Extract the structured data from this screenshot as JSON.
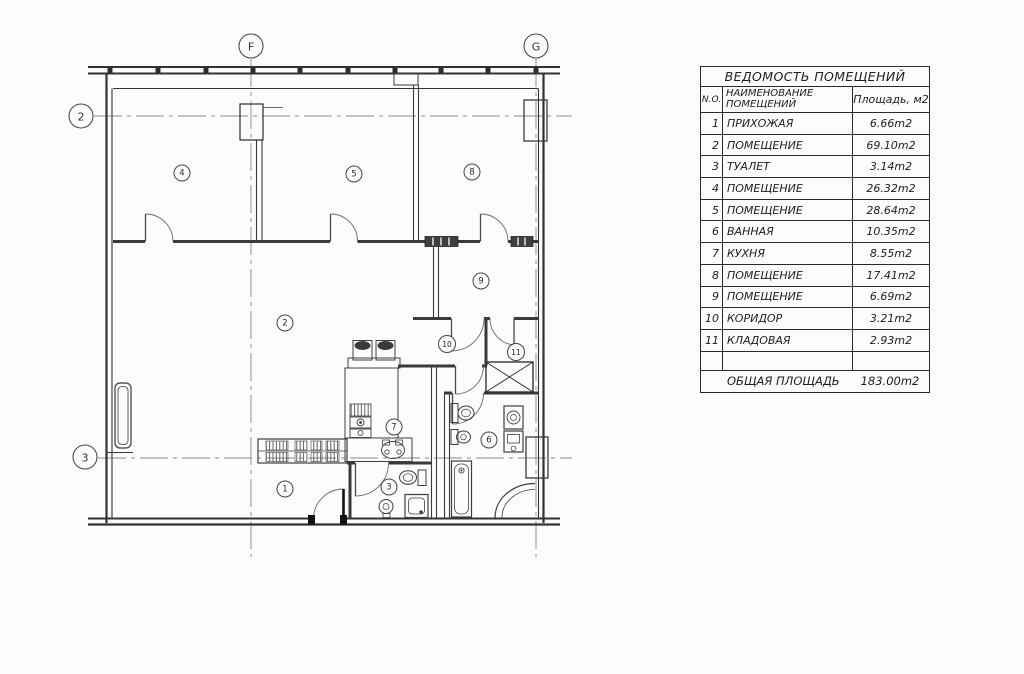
{
  "plan": {
    "grid_markers": [
      {
        "label": "F"
      },
      {
        "label": "G"
      },
      {
        "label": "2"
      },
      {
        "label": "3"
      }
    ],
    "rooms": [
      {
        "label": "1"
      },
      {
        "label": "2"
      },
      {
        "label": "3"
      },
      {
        "label": "4"
      },
      {
        "label": "5"
      },
      {
        "label": "6"
      },
      {
        "label": "7"
      },
      {
        "label": "8"
      },
      {
        "label": "9"
      },
      {
        "label": "10"
      },
      {
        "label": "11"
      }
    ]
  },
  "table": {
    "title": "ВЕДОМОСТЬ  ПОМЕЩЕНИЙ",
    "col_no": "N.O.",
    "col_name_line1": "НАИМЕНОВАНИЕ",
    "col_name_line2": "ПОМЕЩЕНИЙ",
    "col_area": "Площадь, м2",
    "rows": [
      {
        "n": "1",
        "name": "ПРИХОЖАЯ",
        "area": "6.66m2"
      },
      {
        "n": "2",
        "name": "ПОМЕЩЕНИЕ",
        "area": "69.10m2"
      },
      {
        "n": "3",
        "name": "ТУАЛЕТ",
        "area": "3.14m2"
      },
      {
        "n": "4",
        "name": "ПОМЕЩЕНИЕ",
        "area": "26.32m2"
      },
      {
        "n": "5",
        "name": "ПОМЕЩЕНИЕ",
        "area": "28.64m2"
      },
      {
        "n": "6",
        "name": "ВАННАЯ",
        "area": "10.35m2"
      },
      {
        "n": "7",
        "name": "КУХНЯ",
        "area": "8.55m2"
      },
      {
        "n": "8",
        "name": "ПОМЕЩЕНИЕ",
        "area": "17.41m2"
      },
      {
        "n": "9",
        "name": "ПОМЕЩЕНИЕ",
        "area": "6.69m2"
      },
      {
        "n": "10",
        "name": "КОРИДОР",
        "area": "3.21m2"
      },
      {
        "n": "11",
        "name": "КЛАДОВАЯ",
        "area": "2.93m2"
      }
    ],
    "total_label": "ОБЩАЯ  ПЛОЩАДЬ",
    "total_value": "183.00m2"
  },
  "colors": {
    "line": "#3a3a3a",
    "wall": "#333333",
    "axis": "#8a8a8a",
    "text": "#1d1d1d"
  }
}
